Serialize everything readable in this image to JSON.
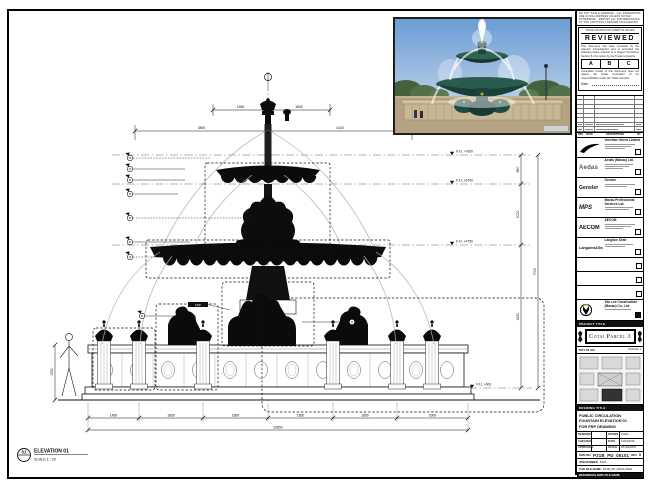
{
  "top_notes": {
    "line": "DO NOT SCALE DRAWING · ALL DIMENSIONS ARE IN MILLIMETRES UNLESS NOTED OTHERWISE · REPORT ALL DISCREPANCIES TO THE ARCHITECT BEFORE PROCEEDING"
  },
  "stamp": {
    "header": "TRADE CONTRACTOR SUBMITTAL REVIEW",
    "title": "REVIEWED",
    "body1": "This document has been reviewed by the relevant Consultant(s) and is accorded the following status referred to in Project Procedure Section 5.4 for action by the Trade Contractor.",
    "grades": [
      "A",
      "B",
      "C"
    ],
    "body2": "Consultant review of this document does not relieve the Trade Contractor of his responsibilities under the Trade Contract.",
    "date_label": "Date :"
  },
  "rev_table": {
    "headers": [
      "REV",
      "DATE",
      "DESCRIPTION",
      "BY"
    ]
  },
  "companies": [
    {
      "name": "Venetian Orient Limited",
      "logo_text": ""
    },
    {
      "name": "Aedas (Macau) Ltd.",
      "logo_text": "Aedas"
    },
    {
      "name": "Gensler",
      "logo_text": "Gensler"
    },
    {
      "name": "Macau Professional Services Ltd.",
      "logo_text": "MPS"
    },
    {
      "name": "AECOM",
      "logo_text": "AECOM"
    },
    {
      "name": "Langdon Seah",
      "logo_text": "Langdon&Seah"
    }
  ],
  "contractor": {
    "line1": "Yau Lee Construction",
    "line2": "(Macau) Co., Ltd."
  },
  "project": {
    "label": "PROJECT TITLE",
    "name": "Cotai Parcel 3"
  },
  "key_plan": {
    "label": "KEY PLAN",
    "sublabel": "PARCEL 3"
  },
  "drawing_title": {
    "label": "DRAWING TITLE",
    "lines": [
      "PUBLIC CIRCULATION",
      "FOUNTAIN ELEVATION 01",
      "FOR FRP DRAWING"
    ]
  },
  "fields": {
    "designed_label": "DESIGNED",
    "designed": "",
    "checked_label": "CHECKED",
    "checked": "-",
    "approved_label": "APPROVED",
    "approved": "-",
    "drawn_label": "DRAWN",
    "drawn": "CHAO",
    "date_label": "DATE",
    "date": "12/04/2016",
    "scale_label": "SCALE",
    "scale": "AS SHOWN"
  },
  "dwg": {
    "no_label": "DWG NO.",
    "no": "P31B_PD_05101",
    "rev_label": "REV",
    "rev": "0",
    "job_label": "JOB NUMBER",
    "job": "5123",
    "file_label": "CAD FILE NAME",
    "file": "P31B_PD_05101.DWG",
    "ref_label": "REFERENCE DWG FILE NAME"
  },
  "elevation": {
    "number": "01",
    "title": "ELEVATION 01",
    "scale": "SCALE 1 : 25"
  },
  "drawing": {
    "levels": [
      "F.F.L +7600",
      "F.F.L +6750",
      "F.F.L +4750",
      "F.F.L +600"
    ],
    "dims_top_a": [
      "1550",
      "1800"
    ],
    "dims_top_b": [
      "3800",
      "4100"
    ],
    "dims_right": [
      "850",
      "2000",
      "4150"
    ],
    "dim_right_total": "7000",
    "dims_bottom": [
      "1450",
      "1850",
      "1850",
      "1850",
      "1850",
      "2000"
    ],
    "dim_bottom_total": "10850",
    "dim_left": "1550",
    "statue_tag": "FRP"
  }
}
